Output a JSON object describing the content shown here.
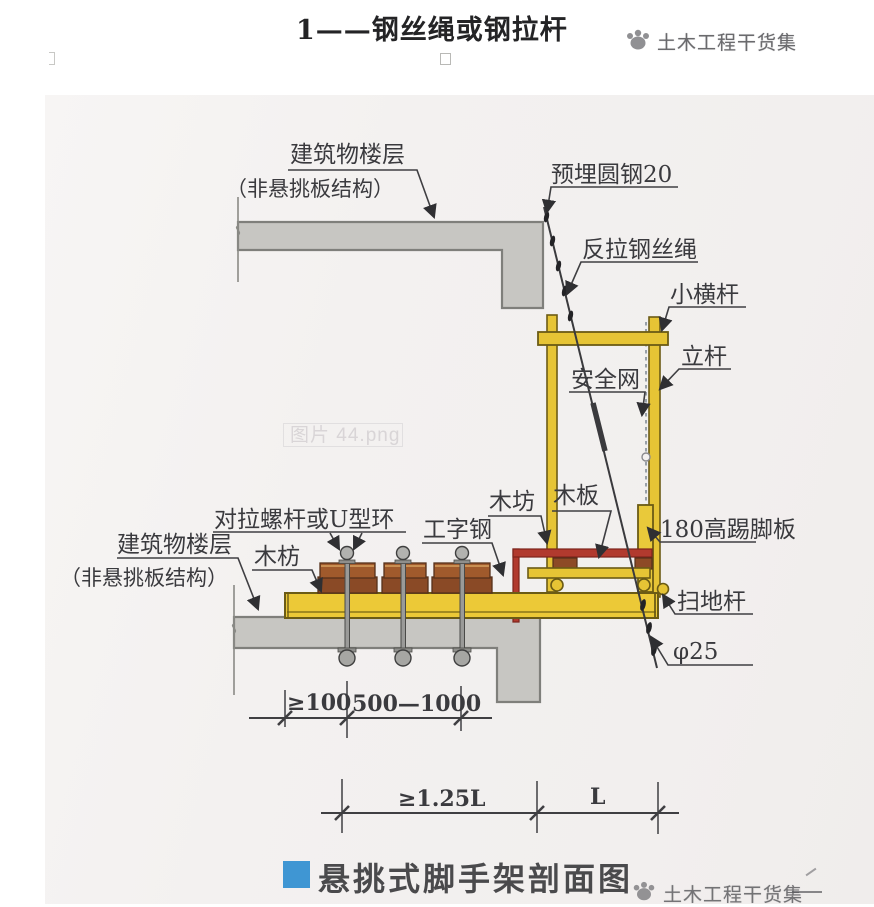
{
  "page": {
    "header": {
      "figure_note": "1——钢丝绳或钢拉杆",
      "watermark": "土木工程干货集"
    },
    "caption": {
      "title": "悬挑式脚手架剖面图",
      "watermark": "土木工程干货集"
    },
    "photo_watermark": "图片 44.png"
  },
  "diagram": {
    "labels": {
      "building_floor_upper": "建筑物楼层",
      "building_floor_upper_sub": "（非悬挑板结构）",
      "embedded_round_steel": "预埋圆钢20",
      "counter_pull_wire_rope": "反拉钢丝绳",
      "small_crossbar": "小横杆",
      "vertical_pole": "立杆",
      "safety_net": "安全网",
      "tie_bolt_or_u_ring": "对拉螺杆或U型环",
      "wood_batten_left": "木枋",
      "i_beam": "工字钢",
      "wood_batten_center": "木坊",
      "wood_plank": "木板",
      "toe_board": "180高踢脚板",
      "sweeping_rod": "扫地杆",
      "phi_25": "φ25",
      "building_floor_lower": "建筑物楼层",
      "building_floor_lower_sub": "（非悬挑板结构）"
    },
    "dimensions": {
      "anchor_edge_distance": "≥100",
      "bolt_spacing": "500—1000",
      "inner_anchor_span": "≥1.25L",
      "cantilever_span": "L"
    },
    "colors": {
      "paper": "#f3f1f0",
      "slab_gray": "#c7c6c2",
      "steel_yellow": "#e8c838",
      "anchor_red": "#b13a2e",
      "wood_brown": "#8d4a26",
      "line_dark": "#3f3f42",
      "caption_blue": "#3f96d3"
    }
  }
}
